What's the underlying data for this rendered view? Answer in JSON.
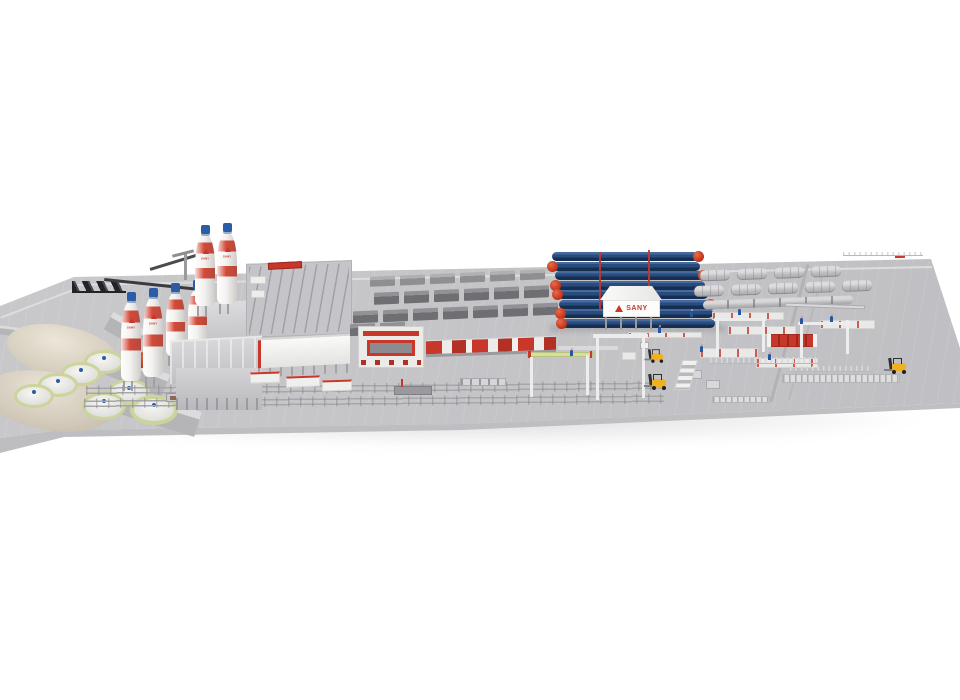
{
  "image": {
    "title": "3D rendered aerial overview of a SANY precast concrete pile factory on a light gray yard with white background",
    "background": "#ffffff"
  },
  "branding": {
    "name": "SANY",
    "building_label": "SANY",
    "silo_label": "SANY",
    "logo_shape": "red-triangle-icon",
    "logo_color": "#c9372a"
  },
  "objects": {
    "sand_piles": 2,
    "wheel_loaders": 1,
    "cement_silos": 6,
    "slurry_tanks": 7,
    "autoclaves": 8,
    "autoclave_doors_red": 8,
    "mold_rows": 4,
    "product_bundle_rows": 3,
    "forklifts": 3,
    "workers": 8,
    "gantry_cranes": 2,
    "transfer_carts": 3
  },
  "colors": {
    "ground": "#c9c9cc",
    "ground_edge": "#b2b2b6",
    "sand": "#cfc7b5",
    "silo_red": "#d23a28",
    "cap_blue": "#2b5ca6",
    "tank_rim": "#ccd49b",
    "autoclave_blue": "#2a4c7d",
    "autoclave_dark": "#152f52",
    "door_red": "#c03318",
    "machine_red": "#c9372a",
    "logo_red": "#c9372a",
    "lime": "#d7dfa0",
    "forklift_yellow": "#efb11d",
    "loader_yellow": "#e8a21a",
    "product_gray": "#bebec1",
    "slab_gray": "#6e6e73",
    "worker_blue": "#2456a5"
  }
}
